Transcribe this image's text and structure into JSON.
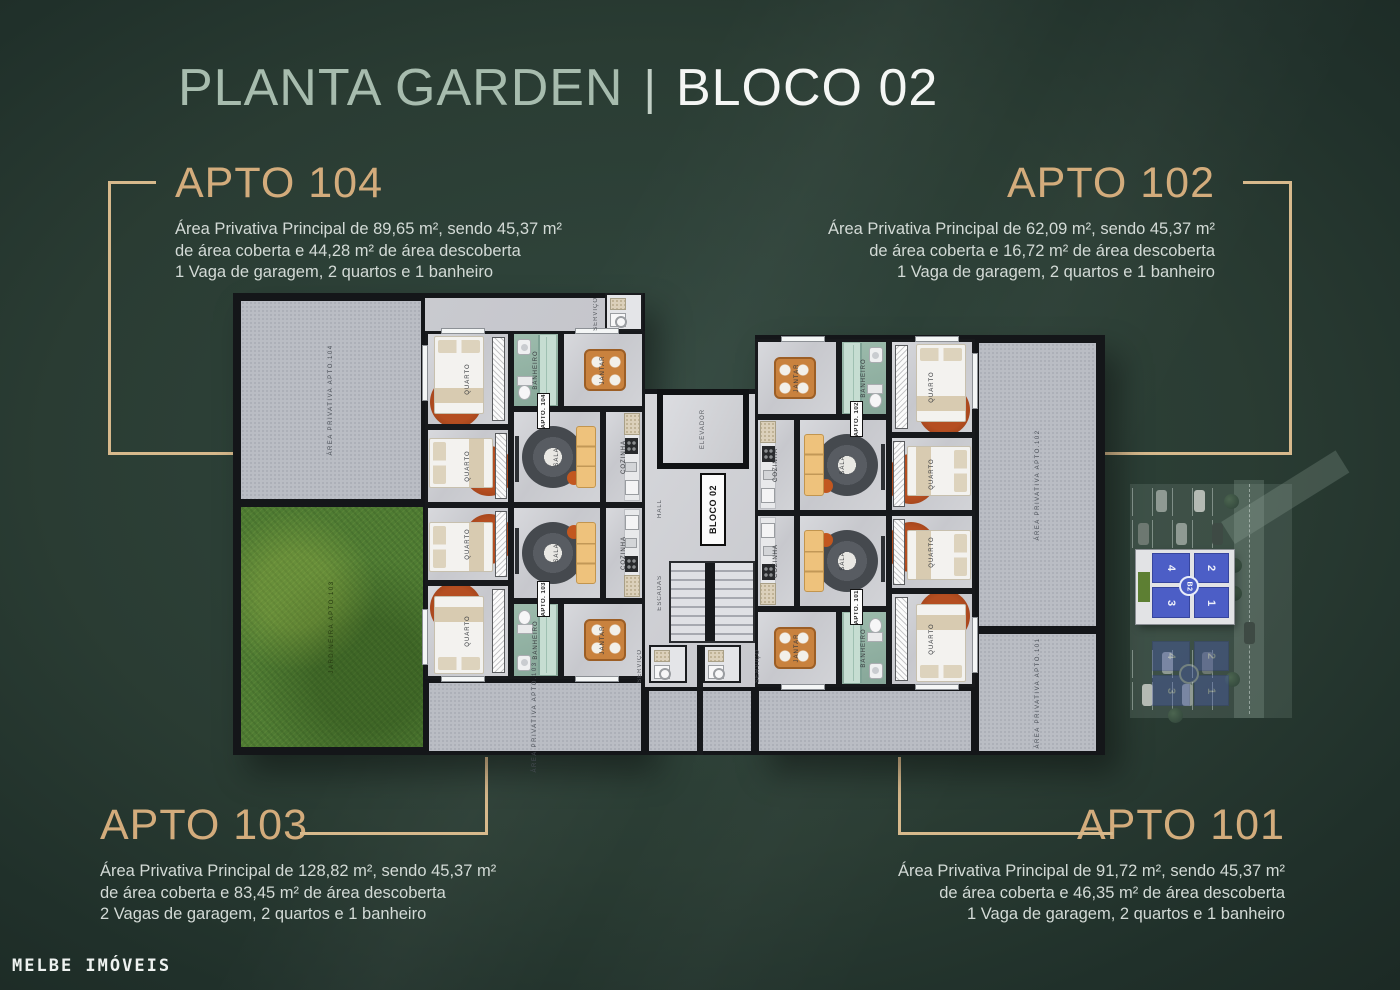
{
  "header": {
    "title": "PLANTA GARDEN",
    "separator": "|",
    "block": "BLOCO 02"
  },
  "apartments": [
    {
      "name": "APTO 104",
      "line1": "Área Privativa Principal de 89,65 m², sendo 45,37 m²",
      "line2": "de área coberta e 44,28 m² de área descoberta",
      "line3": "1 Vaga de garagem, 2 quartos e 1 banheiro"
    },
    {
      "name": "APTO 102",
      "line1": "Área Privativa Principal de 62,09 m², sendo 45,37 m²",
      "line2": "de área coberta e 16,72 m² de área descoberta",
      "line3": "1 Vaga de garagem, 2 quartos e 1 banheiro"
    },
    {
      "name": "APTO 103",
      "line1": "Área Privativa Principal de 128,82 m², sendo 45,37 m²",
      "line2": "de área coberta e 83,45 m² de área descoberta",
      "line3": "2 Vagas de garagem, 2 quartos e 1 banheiro"
    },
    {
      "name": "APTO 101",
      "line1": "Área Privativa Principal de 91,72 m², sendo 45,37 m²",
      "line2": "de área coberta e 46,35 m² de área descoberta",
      "line3": "1 Vaga de garagem, 2 quartos e 1 banheiro"
    }
  ],
  "floorplan": {
    "rooms": {
      "quarto": "QUARTO",
      "banheiro": "BANHEIRO",
      "sala": "SALA",
      "jantar": "JANTAR",
      "cozinha": "COZINHA",
      "hall": "HALL",
      "servico": "SERVIÇO",
      "elevador": "ELEVADOR",
      "escadas": "ESCADAS"
    },
    "areas": {
      "apto104": "ÁREA PRIVATIVA APTO.104",
      "apto102": "ÁREA PRIVATIVA APTO.102",
      "apto103": "ÁREA PRIVATIVA APTO.103",
      "apto101": "ÁREA PRIVATIVA APTO.101",
      "jardineira": "JARDINEIRA APTO.103"
    },
    "unit_tags": {
      "u104": "APTO. 104",
      "u102": "APTO. 102",
      "u103": "APTO. 103",
      "u101": "APTO. 101"
    },
    "block_tag": "BLOCO 02"
  },
  "site_inset": {
    "badge": "B2",
    "units": [
      "4",
      "2",
      "3",
      "1"
    ]
  },
  "footer": {
    "brand": "MELBE IMÓVEIS"
  },
  "colors": {
    "accent_gold": "#d3ac7c",
    "title_sage": "#a7bcae",
    "text_light": "#d3dad6",
    "site_unit_blue": "#4c5ec6"
  }
}
